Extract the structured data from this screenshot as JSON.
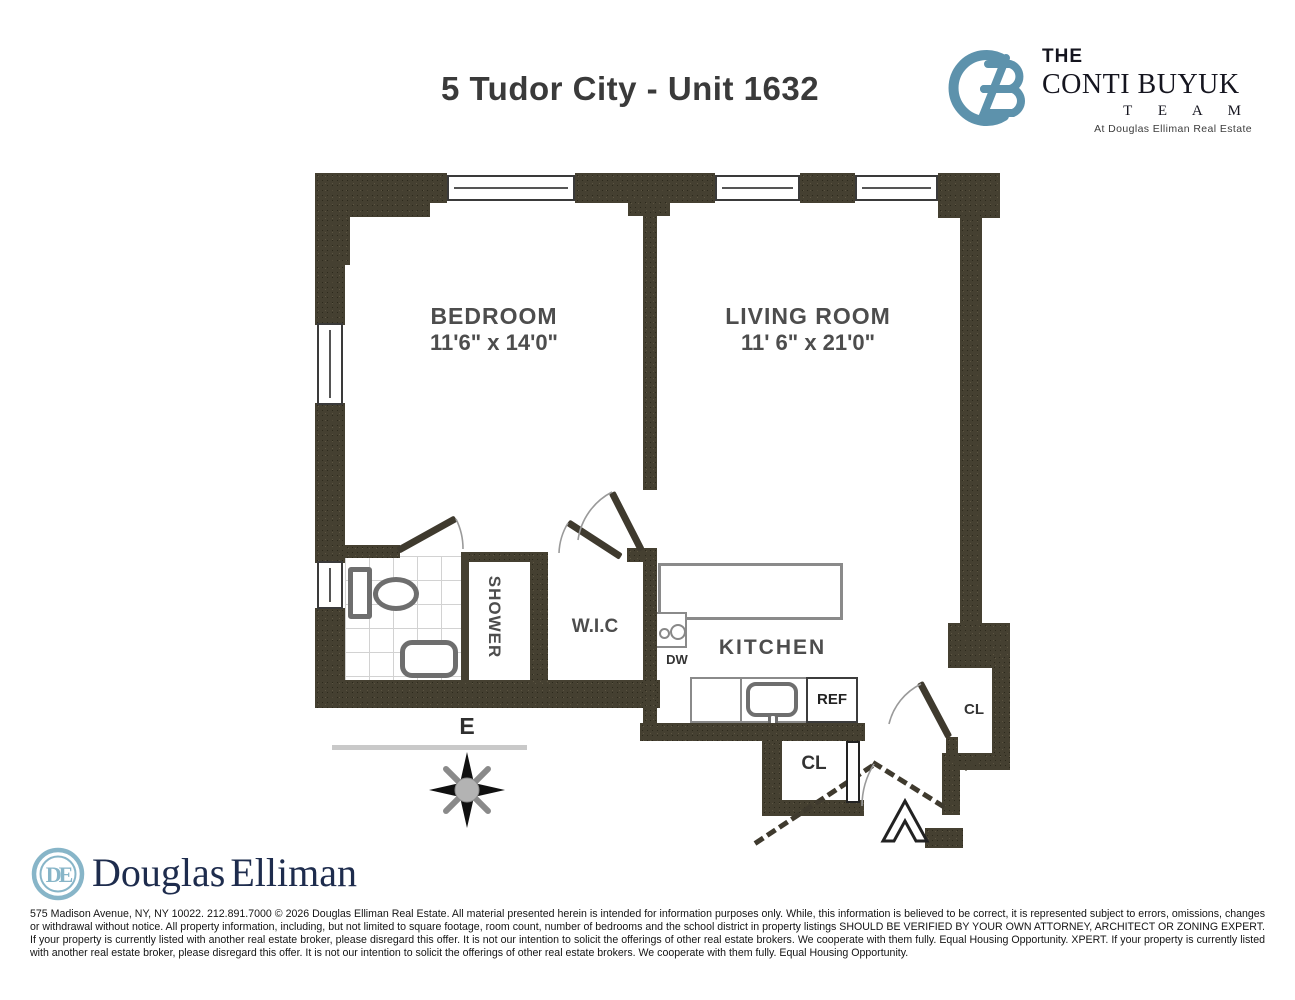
{
  "header": {
    "title": "5 Tudor City - Unit 1632",
    "logo": {
      "monogram": "CB",
      "line1": "THE",
      "line2": "CONTI BUYUK",
      "line3": "T E A M",
      "line4": "At Douglas Elliman Real Estate"
    }
  },
  "plan": {
    "bedroom_label": "BEDROOM",
    "bedroom_dims": "11'6\" x 14'0\"",
    "living_label": "LIVING ROOM",
    "living_dims": "11' 6\" x 21'0\"",
    "kitchen_label": "KITCHEN",
    "shower_label": "SHOWER",
    "wic_label": "W.I.C",
    "dw_label": "DW",
    "ref_label": "REF",
    "closet_right_label": "CL",
    "closet_bottom_label": "CL",
    "compass_label": "E"
  },
  "footer": {
    "brand_first": "Douglas",
    "brand_second": "Elliman",
    "monogram": "DE",
    "disclaimer_lines": [
      "575 Madison Avenue, NY, NY 10022. 212.891.7000 © 2026 Douglas Elliman Real Estate. All material presented herein is intended for information purposes only. While, this information is believed to be correct, it is represented subject to errors, omissions, changes or withdrawal without notice. All property",
      "information, including, but not limited to square footage, room count, number of bedrooms and the school district in property listings SHOULD BE VERIFIED BY YOUR OWN ATTORNEY, ARCHITECT OR ZONING EXPERT. If your property is currently listed with another real estate broker, please disregard",
      "this offer. It is not our intention to solicit the offerings of other real estate brokers. We cooperate with them fully. Equal Housing Opportunity.  XPERT. If your property is currently listed with another real estate broker, please disregard this offer. It is not our intention to solicit the offerings of other real estate",
      "brokers. We cooperate with them fully. Equal Housing Opportunity."
    ]
  },
  "colors": {
    "wall": "#454031",
    "logo_blue": "#5d92ac",
    "logo_navy": "#15151f",
    "de_blue": "#87b5c8",
    "de_navy": "#1e2c4d",
    "label_gray": "#4d4d4d"
  }
}
